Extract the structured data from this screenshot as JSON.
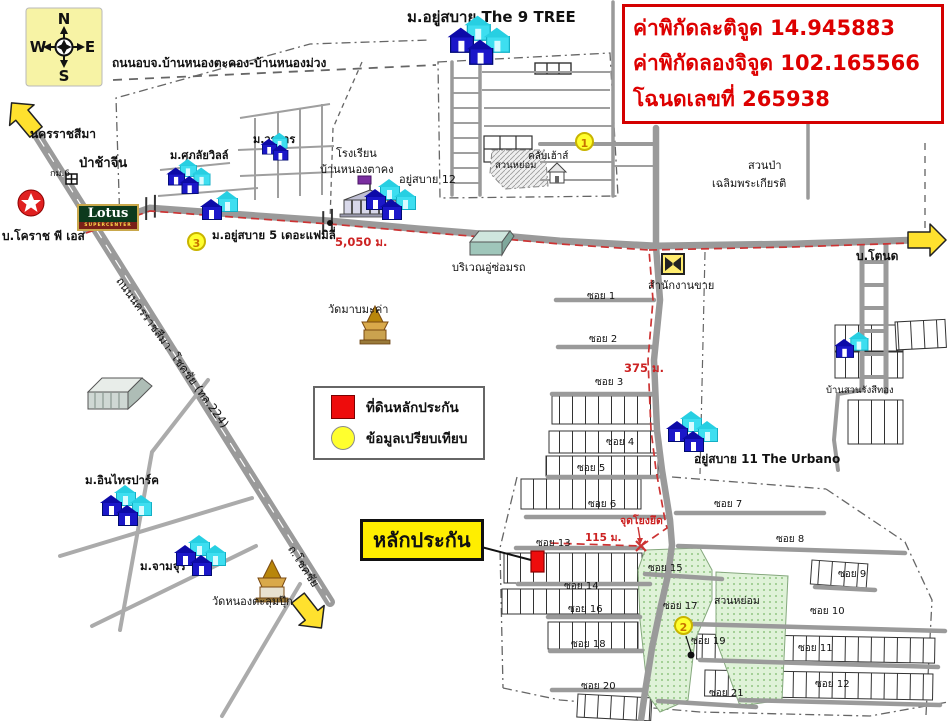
{
  "info_box": {
    "lines": [
      "ค่าพิกัดละติจูด 14.945883",
      "ค่าพิกัดลองจิจูด 102.165566",
      "โฉนดเลขที่ 265938"
    ]
  },
  "compass": {
    "n": "N",
    "s": "S",
    "e": "E",
    "w": "W"
  },
  "legend": {
    "items": [
      {
        "symbol": "red-square",
        "text": "ที่ดินหลักประกัน"
      },
      {
        "symbol": "yellow-circle",
        "text": "ข้อมูลเปรียบเทียบ"
      }
    ]
  },
  "collateral_tag": {
    "text": "หลักประกัน"
  },
  "lotus": {
    "name": "Lotus",
    "sub": "SUPERCENTER"
  },
  "markers": [
    {
      "id": "marker-1",
      "num": "1",
      "x": 585,
      "y": 142
    },
    {
      "id": "marker-2",
      "num": "2",
      "x": 684,
      "y": 626
    },
    {
      "id": "marker-3",
      "num": "3",
      "x": 197,
      "y": 242
    }
  ],
  "map_labels": [
    {
      "id": "label-road-obj",
      "text": "ถนนอบจ.บ้านหนองตะคอง-บ้านหนองม่วง",
      "x": 112,
      "y": 54,
      "size": 12,
      "bold": true
    },
    {
      "id": "label-nakhonratchasima",
      "text": "นครราชสีมา",
      "x": 30,
      "y": 125,
      "size": 12,
      "bold": true
    },
    {
      "id": "label-chinese-cemetery",
      "text": "ป่าช้าจีน",
      "x": 79,
      "y": 152,
      "size": 13,
      "bold": true
    },
    {
      "id": "label-km6",
      "text": "กม.6",
      "x": 50,
      "y": 166,
      "size": 9
    },
    {
      "id": "label-worakan",
      "text": "ม.วรการ",
      "x": 253,
      "y": 130,
      "size": 11,
      "bold": true
    },
    {
      "id": "label-supalai-ville",
      "text": "ม.ศุภลัยวิลล์",
      "x": 170,
      "y": 146,
      "size": 11,
      "bold": true
    },
    {
      "id": "label-9tree",
      "text": "ม.อยู่สบาย The 9 TREE",
      "x": 407,
      "y": 5,
      "size": 15,
      "bold": true
    },
    {
      "id": "label-school-1",
      "text": "โรงเรียน",
      "x": 336,
      "y": 144,
      "size": 11
    },
    {
      "id": "label-school-2",
      "text": "บ้านหนองตาคง",
      "x": 320,
      "y": 160,
      "size": 11
    },
    {
      "id": "label-yusabai12",
      "text": "อยู่สบาย 12",
      "x": 399,
      "y": 170,
      "size": 11
    },
    {
      "id": "label-suanyom-top",
      "text": "สวนหย่อม",
      "x": 495,
      "y": 158,
      "size": 9.5
    },
    {
      "id": "label-clubhouse",
      "text": "คลับเฮ้าส์",
      "x": 528,
      "y": 149,
      "size": 10
    },
    {
      "id": "label-suanpa-1",
      "text": "สวนป่า",
      "x": 748,
      "y": 156,
      "size": 11
    },
    {
      "id": "label-suanpa-2",
      "text": "เฉลิมพระเกียรติ",
      "x": 712,
      "y": 174,
      "size": 11
    },
    {
      "id": "label-yusabai5",
      "text": "ม.อยู่สบาย 5 เดอะแฟมิลี่",
      "x": 212,
      "y": 227,
      "size": 11.5,
      "bold": true
    },
    {
      "id": "label-dist-5050",
      "text": "5,050 ม.",
      "x": 335,
      "y": 234,
      "size": 11.5,
      "bold": true,
      "color": "#cc2222"
    },
    {
      "id": "label-korat-ps",
      "text": "บ.โคราช พี เอส",
      "x": 2,
      "y": 227,
      "size": 12,
      "bold": true
    },
    {
      "id": "label-repair-shop",
      "text": "บริเวณอู่ซ่อมรถ",
      "x": 452,
      "y": 258,
      "size": 11
    },
    {
      "id": "label-sales-office",
      "text": "สำนักงานขาย",
      "x": 648,
      "y": 276,
      "size": 11
    },
    {
      "id": "label-wat-mab-makha",
      "text": "วัดมาบมะค่า",
      "x": 328,
      "y": 300,
      "size": 11
    },
    {
      "id": "label-tondet",
      "text": "บ.โตนด",
      "x": 856,
      "y": 247,
      "size": 12,
      "bold": true
    },
    {
      "id": "label-ban-suan",
      "text": "บ้านสวนรังสีทอง",
      "x": 826,
      "y": 383,
      "size": 9.5
    },
    {
      "id": "label-urbano",
      "text": "อยู่สบาย 11 The Urbano",
      "x": 694,
      "y": 450,
      "size": 12,
      "bold": true
    },
    {
      "id": "label-dist-375",
      "text": "375 ม.",
      "x": 624,
      "y": 360,
      "size": 11.5,
      "bold": true,
      "color": "#cc2222"
    },
    {
      "id": "label-anchor-point",
      "text": "จุดโยงยึด",
      "x": 620,
      "y": 512,
      "size": 10.5,
      "bold": true,
      "color": "#cc2222"
    },
    {
      "id": "label-dist-115",
      "text": "115 ม.",
      "x": 585,
      "y": 529,
      "size": 10.5,
      "bold": true,
      "color": "#cc2222"
    },
    {
      "id": "label-intara-park",
      "text": "ม.อินไทรปาร์ค",
      "x": 85,
      "y": 472,
      "size": 11.5,
      "bold": true
    },
    {
      "id": "label-chamchuri",
      "text": "ม.จามจุรี",
      "x": 140,
      "y": 558,
      "size": 11.5,
      "bold": true
    },
    {
      "id": "label-wat-nong",
      "text": "วัดหนองตะลุมปุ๊ก",
      "x": 212,
      "y": 592,
      "size": 11
    },
    {
      "id": "label-chokchai-road",
      "text": "ถ.โชคชัย",
      "x": 290,
      "y": 538,
      "size": 11.5,
      "rotate": 57
    },
    {
      "id": "label-highway-224",
      "text": "ถนนนครราชสีมา- โชคชัย (ทล.224)",
      "x": 118,
      "y": 270,
      "size": 11.5,
      "rotate": 54
    },
    {
      "id": "label-soi-1",
      "text": "ซอย 1",
      "x": 587,
      "y": 289,
      "size": 10
    },
    {
      "id": "label-soi-2",
      "text": "ซอย 2",
      "x": 589,
      "y": 332,
      "size": 10
    },
    {
      "id": "label-soi-3",
      "text": "ซอย 3",
      "x": 595,
      "y": 375,
      "size": 10
    },
    {
      "id": "label-soi-4",
      "text": "ซอย 4",
      "x": 606,
      "y": 435,
      "size": 10
    },
    {
      "id": "label-soi-5",
      "text": "ซอย 5",
      "x": 577,
      "y": 461,
      "size": 10
    },
    {
      "id": "label-soi-6",
      "text": "ซอย 6",
      "x": 588,
      "y": 497,
      "size": 10
    },
    {
      "id": "label-soi-7",
      "text": "ซอย 7",
      "x": 714,
      "y": 497,
      "size": 10
    },
    {
      "id": "label-soi-8",
      "text": "ซอย 8",
      "x": 776,
      "y": 532,
      "size": 10
    },
    {
      "id": "label-soi-9",
      "text": "ซอย 9",
      "x": 838,
      "y": 567,
      "size": 10
    },
    {
      "id": "label-soi-10",
      "text": "ซอย 10",
      "x": 810,
      "y": 604,
      "size": 10
    },
    {
      "id": "label-soi-11",
      "text": "ซอย 11",
      "x": 798,
      "y": 641,
      "size": 10
    },
    {
      "id": "label-soi-12",
      "text": "ซอย 12",
      "x": 815,
      "y": 677,
      "size": 10
    },
    {
      "id": "label-soi-13",
      "text": "ซอย 13",
      "x": 536,
      "y": 536,
      "size": 10
    },
    {
      "id": "label-soi-14",
      "text": "ซอย 14",
      "x": 564,
      "y": 579,
      "size": 10
    },
    {
      "id": "label-soi-15",
      "text": "ซอย 15",
      "x": 648,
      "y": 561,
      "size": 10
    },
    {
      "id": "label-soi-16",
      "text": "ซอย 16",
      "x": 568,
      "y": 602,
      "size": 10
    },
    {
      "id": "label-soi-17",
      "text": "ซอย 17",
      "x": 663,
      "y": 599,
      "size": 10
    },
    {
      "id": "label-soi-18",
      "text": "ซอย 18",
      "x": 571,
      "y": 637,
      "size": 10
    },
    {
      "id": "label-soi-19",
      "text": "ซอย 19",
      "x": 691,
      "y": 634,
      "size": 10
    },
    {
      "id": "label-soi-20",
      "text": "ซอย 20",
      "x": 581,
      "y": 679,
      "size": 10
    },
    {
      "id": "label-soi-21",
      "text": "ซอย 21",
      "x": 709,
      "y": 686,
      "size": 10
    },
    {
      "id": "label-suanyom-bottom",
      "text": "สวนหย่อม",
      "x": 714,
      "y": 592,
      "size": 10.5
    }
  ],
  "house_clusters": [
    {
      "id": "houses-9tree",
      "x": 450,
      "y": 24,
      "p": "2b2c",
      "sc": 1.2
    },
    {
      "id": "houses-worakan",
      "x": 262,
      "y": 138,
      "p": "2b1c",
      "sc": 0.75
    },
    {
      "id": "houses-supalai",
      "x": 168,
      "y": 165,
      "p": "2b2c",
      "sc": 0.85
    },
    {
      "id": "houses-yusabai5",
      "x": 202,
      "y": 198,
      "p": "1b1c",
      "sc": 1
    },
    {
      "id": "houses-yusabai12",
      "x": 366,
      "y": 186,
      "p": "2b2c",
      "sc": 1
    },
    {
      "id": "houses-urbano",
      "x": 668,
      "y": 418,
      "p": "2b2c",
      "sc": 1
    },
    {
      "id": "houses-ban-suan",
      "x": 836,
      "y": 338,
      "p": "1b1c",
      "sc": 0.9
    },
    {
      "id": "houses-intara-park",
      "x": 102,
      "y": 492,
      "p": "2b2c",
      "sc": 1
    },
    {
      "id": "houses-chamchuri",
      "x": 176,
      "y": 542,
      "p": "2b2c",
      "sc": 1
    }
  ],
  "colors": {
    "road": "#9a9a9a",
    "route_red": "#cc3333",
    "info_red": "#dd0000",
    "marker_yellow": "#ffff2e",
    "arrow_yellow": "#ffe12e",
    "collateral_red": "#ee0c0c",
    "park_green": "#dff2d8",
    "compass_bg": "#f7f3a5",
    "tag_yellow": "#ffee00",
    "house_blue": "#1b17c9",
    "house_cyan": "#3ddef0"
  }
}
